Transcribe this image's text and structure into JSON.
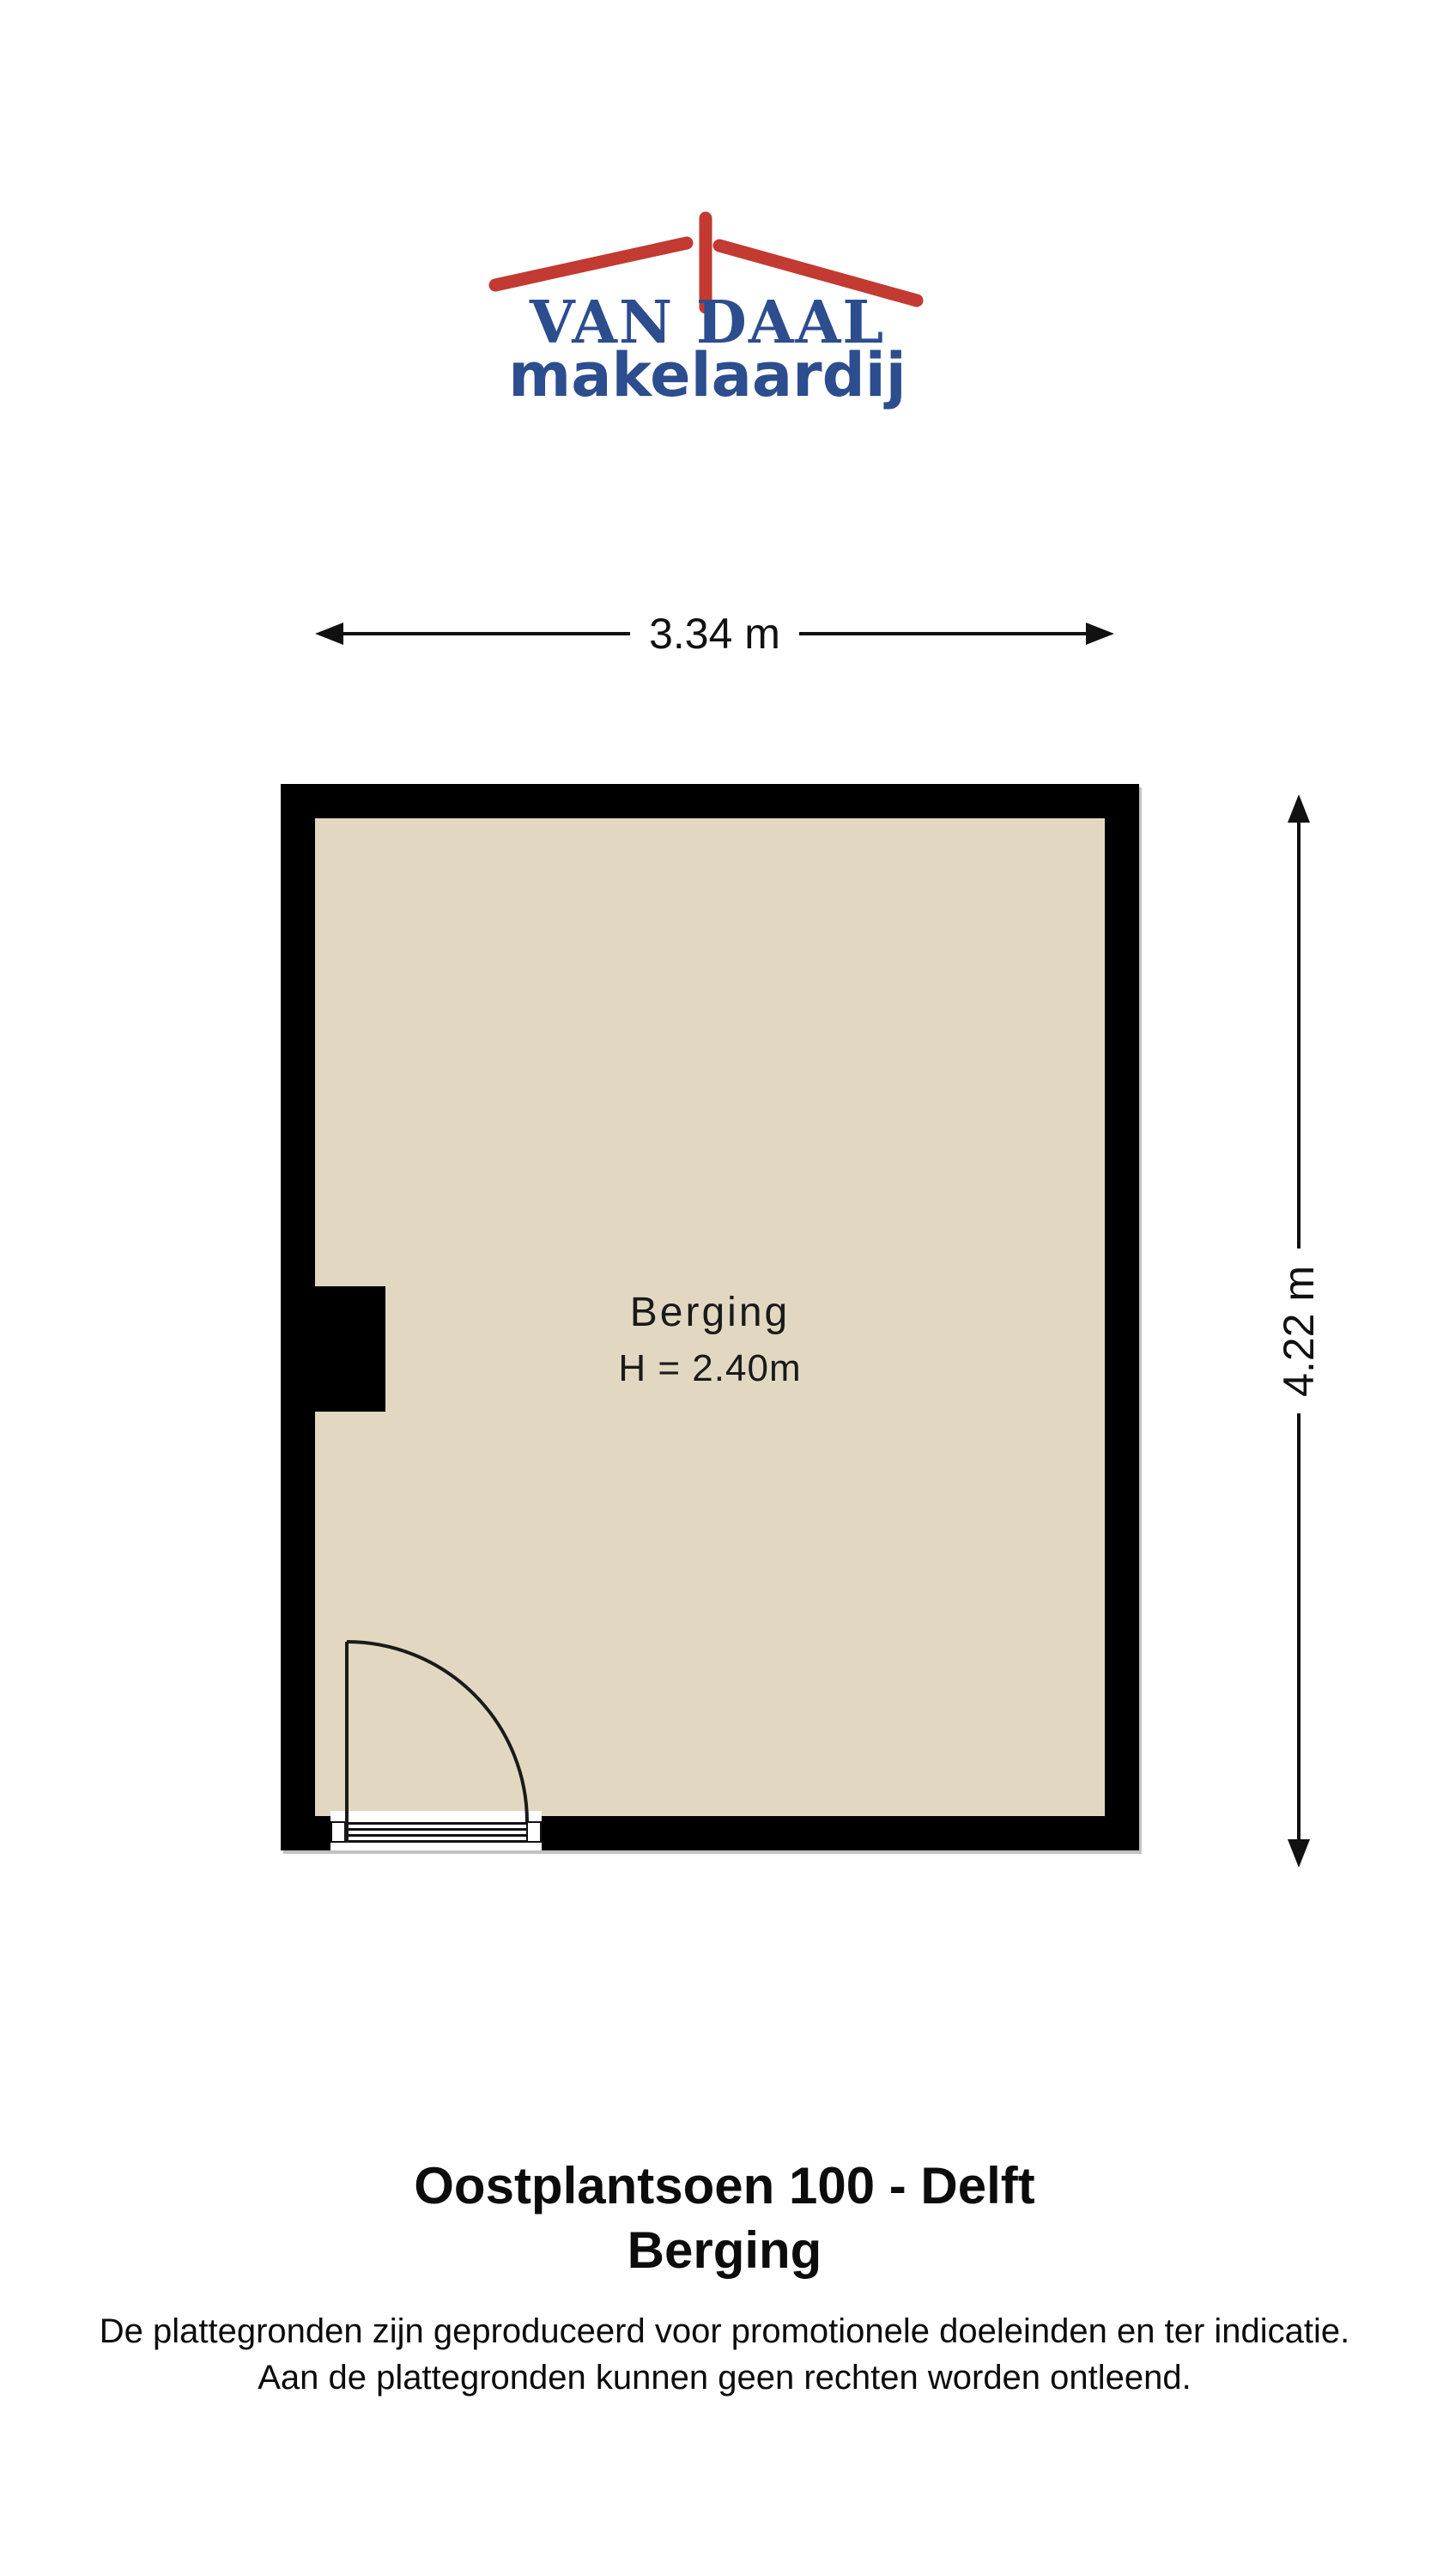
{
  "logo": {
    "title": "VAN DAAL",
    "subtitle": "makelaardij",
    "colors": {
      "blue": "#2C4D8E",
      "red": "#C23A32"
    }
  },
  "floor_plan": {
    "room": {
      "name": "Berging",
      "ceiling_height": "H = 2.40m"
    },
    "dimensions": {
      "width": "3.34 m",
      "height": "4.22 m"
    },
    "colors": {
      "wall": "#000000",
      "floor": "#E2D8C2",
      "dimension_lines": "#111111"
    }
  },
  "footer": {
    "title": "Oostplantsoen 100 - Delft",
    "subtitle": "Berging",
    "disclaimer_line1": "De plattegronden zijn geproduceerd voor promotionele doeleinden en ter indicatie.",
    "disclaimer_line2": "Aan de plattegronden kunnen geen rechten worden ontleend."
  }
}
